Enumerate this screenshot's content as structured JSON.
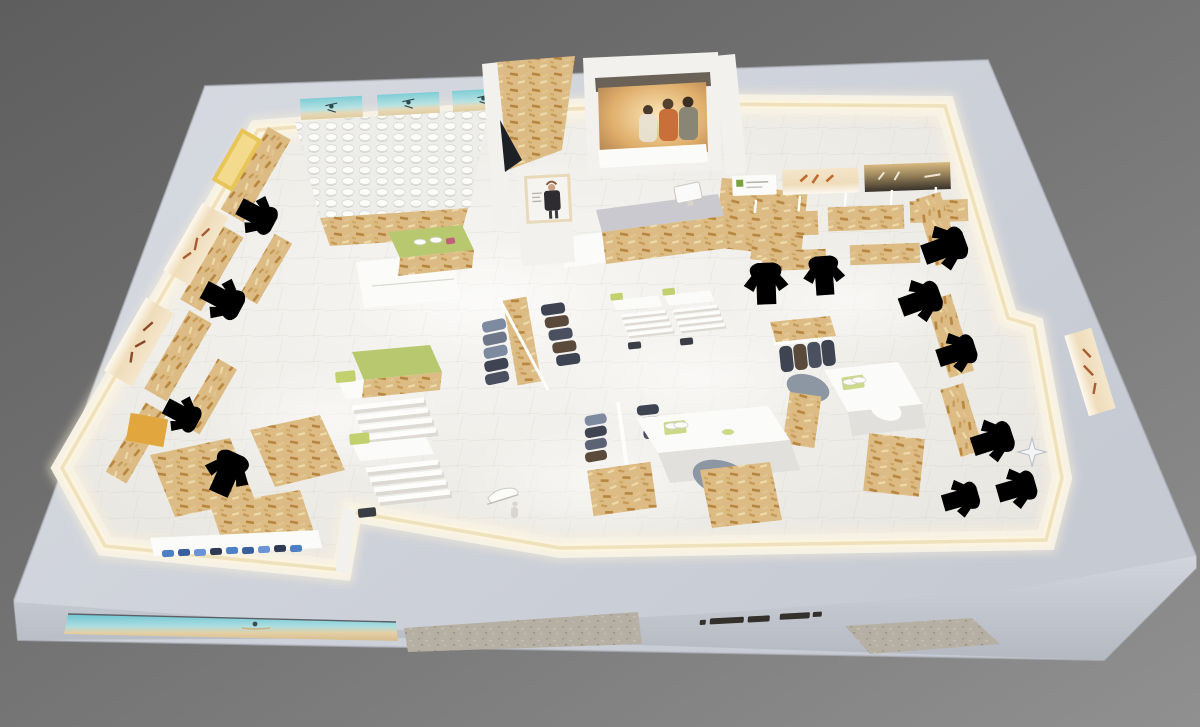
{
  "scene": {
    "label": "3D isometric render of a sportswear retail store floor plan",
    "storefront": {
      "sign_text_visible": true,
      "sign_text_legible": false
    },
    "fixtures": [
      {
        "id": "shoe-wall-room",
        "label": "Back-left shoe display wall with beach mural panels"
      },
      {
        "id": "entrance-osb-wall",
        "label": "Angled OSB entrance wall"
      },
      {
        "id": "sunset-mural-room",
        "label": "Back room with sunset photo mural of three people"
      },
      {
        "id": "cash-counter",
        "label": "OSB cash counter with monitor"
      },
      {
        "id": "poster-column",
        "label": "Column with framed apparel poster"
      },
      {
        "id": "left-wall-displays",
        "label": "Left wall shelving, posters and hanging garments"
      },
      {
        "id": "back-right-wall-displays",
        "label": "Back-right wall posters, OSB shelves and tees"
      },
      {
        "id": "right-wall-displays",
        "label": "Right wall hanging garments, OSB tables, poster"
      },
      {
        "id": "center-racks",
        "label": "Round racks with dark jackets on OSB columns"
      },
      {
        "id": "center-tables",
        "label": "White display tables with lime mats and shoes"
      },
      {
        "id": "gondolas",
        "label": "White slatted gondolas with lime shoe boxes"
      },
      {
        "id": "green-nesting-tables",
        "label": "Lime-top nesting tables"
      },
      {
        "id": "bottom-left-room",
        "label": "Lounge room with OSB benches and blue shoe row"
      },
      {
        "id": "floor-sculpture",
        "label": "White sneaker sculpture near entrance"
      },
      {
        "id": "storefront-band",
        "label": "Front fascia with beach window strip, stone cladding and dark wordmark"
      }
    ]
  },
  "colors": {
    "bg_dark": "#5f5f5f",
    "bg_mid": "#757575",
    "bg_light": "#8f8f8f",
    "roof_light": "#d7dae1",
    "roof": "#cbcfd8",
    "fascia_light": "#d0d3db",
    "fascia_dark": "#b7bbc4",
    "led_core": "#efe1bc",
    "led": "#fbf4e0",
    "led_glow": "#fdf3d9",
    "wall": "#f2f1ee",
    "wall_shade": "#e2e0dc",
    "white": "#fbfbf9",
    "floor_center": "#f6f5f2",
    "floor_edge": "#e9e7e1",
    "osb": "#dcbc84",
    "osb_dark": "#c0934e",
    "osb_light": "#eed9a9",
    "lime": "#b7c86f",
    "lime_light": "#cdd98a",
    "teal": "#7ecdd6",
    "sand": "#e8d9b4",
    "warm": "#f0dfc0",
    "sunset": "#d9a964",
    "sea_dark": "#3a342b",
    "navy": "#3f4452",
    "slate": "#7e8aa0",
    "brown": "#5a4a3c",
    "gray_garment": "#8d97a3",
    "blue": "#4d7fc4",
    "blue_dark": "#2f3b52",
    "stone": "#b6b0a4",
    "logo": "#34302c",
    "counter_top": "#c9c9cf",
    "dark_gap": "#1d2126",
    "skin": "#caa183",
    "jacket": "#2e2c30"
  }
}
